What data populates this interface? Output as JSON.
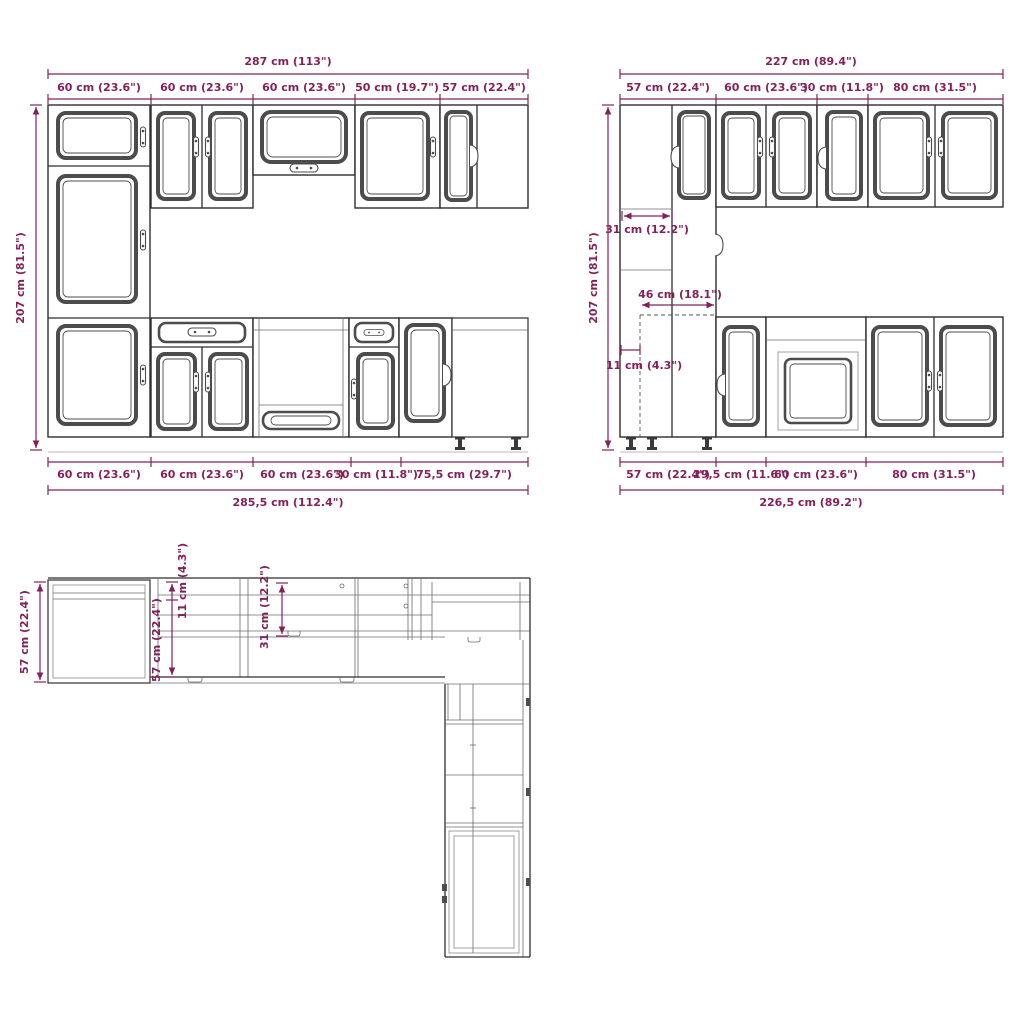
{
  "colors": {
    "dimension": "#84205a",
    "line": "#2e2e2e",
    "background": "#ffffff"
  },
  "front_elevation": {
    "total_width": "287 cm (113\")",
    "segments_top": [
      "60 cm (23.6\")",
      "60 cm (23.6\")",
      "60 cm (23.6\")",
      "50 cm (19.7\")",
      "57 cm (22.4\")"
    ],
    "height": "207 cm (81.5\")",
    "segments_bottom": [
      "60 cm (23.6\")",
      "60 cm (23.6\")",
      "60 cm (23.6\")",
      "30 cm (11.8\")",
      "75,5 cm (29.7\")"
    ],
    "total_width_bottom": "285,5 cm (112.4\")"
  },
  "side_elevation": {
    "total_width": "227 cm (89.4\")",
    "segments_top": [
      "57 cm (22.4\")",
      "60 cm (23.6\")",
      "30 cm (11.8\")",
      "80 cm (31.5\")"
    ],
    "height": "207 cm (81.5\")",
    "upper_depth": "31 cm (12.2\")",
    "counter_depth": "46 cm (18.1\")",
    "plinth_offset": "11 cm (4.3\")",
    "segments_bottom": [
      "57 cm (22.4\")",
      "29,5 cm (11.6\")",
      "60 cm (23.6\")",
      "80 cm (31.5\")"
    ],
    "total_width_bottom": "226,5 cm (89.2\")"
  },
  "plan_view": {
    "depth_total": "57 cm (22.4\")",
    "depth_inner": "57 cm (22.4\")",
    "offset": "11 cm (4.3\")",
    "wall_cabinet_depth": "31 cm (12.2\")"
  }
}
